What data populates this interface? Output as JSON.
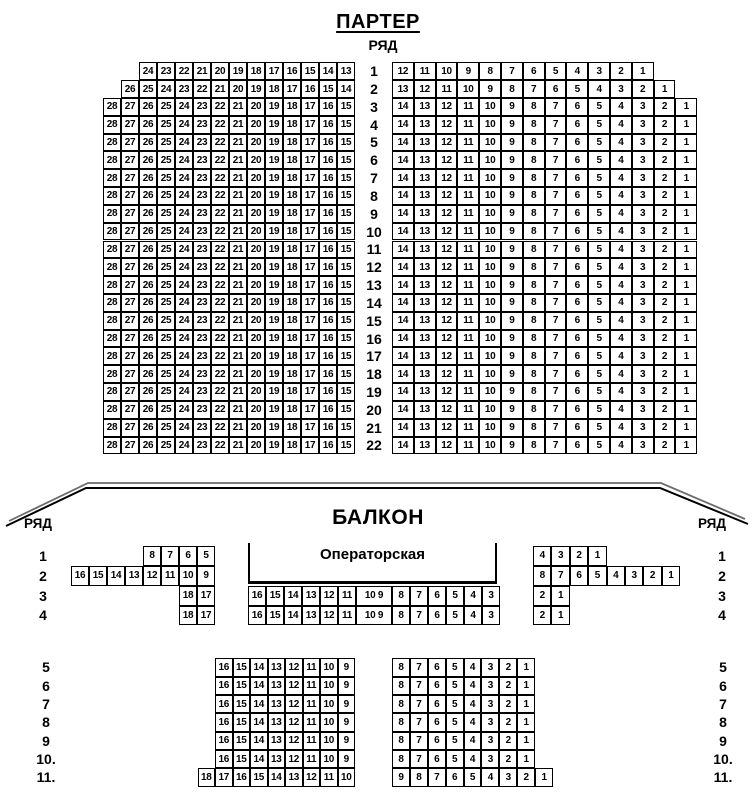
{
  "colors": {
    "ink": "#000000",
    "background": "#ffffff"
  },
  "parterre": {
    "title": "ПАРТЕР",
    "row_header": "РЯД",
    "rows": [
      {
        "row": "1",
        "left": [
          24,
          23,
          22,
          21,
          20,
          19,
          18,
          17,
          16,
          15,
          14,
          13
        ],
        "right": [
          12,
          11,
          10,
          9,
          8,
          7,
          6,
          5,
          4,
          3,
          2,
          1
        ]
      },
      {
        "row": "2",
        "left": [
          26,
          25,
          24,
          23,
          22,
          21,
          20,
          19,
          18,
          17,
          16,
          15,
          14
        ],
        "right": [
          13,
          12,
          11,
          10,
          9,
          8,
          7,
          6,
          5,
          4,
          3,
          2,
          1
        ]
      },
      {
        "row": "3",
        "left": [
          28,
          27,
          26,
          25,
          24,
          23,
          22,
          21,
          20,
          19,
          18,
          17,
          16,
          15
        ],
        "right": [
          14,
          13,
          12,
          11,
          10,
          9,
          8,
          7,
          6,
          5,
          4,
          3,
          2,
          1
        ]
      },
      {
        "row": "4",
        "left": [
          28,
          27,
          26,
          25,
          24,
          23,
          22,
          21,
          20,
          19,
          18,
          17,
          16,
          15
        ],
        "right": [
          14,
          13,
          12,
          11,
          10,
          9,
          8,
          7,
          6,
          5,
          4,
          3,
          2,
          1
        ]
      },
      {
        "row": "5",
        "left": [
          28,
          27,
          26,
          25,
          24,
          23,
          22,
          21,
          20,
          19,
          18,
          17,
          16,
          15
        ],
        "right": [
          14,
          13,
          12,
          11,
          10,
          9,
          8,
          7,
          6,
          5,
          4,
          3,
          2,
          1
        ]
      },
      {
        "row": "6",
        "left": [
          28,
          27,
          26,
          25,
          24,
          23,
          22,
          21,
          20,
          19,
          18,
          17,
          16,
          15
        ],
        "right": [
          14,
          13,
          12,
          11,
          10,
          9,
          8,
          7,
          6,
          5,
          4,
          3,
          2,
          1
        ]
      },
      {
        "row": "7",
        "left": [
          28,
          27,
          26,
          25,
          24,
          23,
          22,
          21,
          20,
          19,
          18,
          17,
          16,
          15
        ],
        "right": [
          14,
          13,
          12,
          11,
          10,
          9,
          8,
          7,
          6,
          5,
          4,
          3,
          2,
          1
        ]
      },
      {
        "row": "8",
        "left": [
          28,
          27,
          26,
          25,
          24,
          23,
          22,
          21,
          20,
          19,
          18,
          17,
          16,
          15
        ],
        "right": [
          14,
          13,
          12,
          11,
          10,
          9,
          8,
          7,
          6,
          5,
          4,
          3,
          2,
          1
        ]
      },
      {
        "row": "9",
        "left": [
          28,
          27,
          26,
          25,
          24,
          23,
          22,
          21,
          20,
          19,
          18,
          17,
          16,
          15
        ],
        "right": [
          14,
          13,
          12,
          11,
          10,
          9,
          8,
          7,
          6,
          5,
          4,
          3,
          2,
          1
        ]
      },
      {
        "row": "10",
        "left": [
          28,
          27,
          26,
          25,
          24,
          23,
          22,
          21,
          20,
          19,
          18,
          17,
          16,
          15
        ],
        "right": [
          14,
          13,
          12,
          11,
          10,
          9,
          8,
          7,
          6,
          5,
          4,
          3,
          2,
          1
        ]
      },
      {
        "row": "11",
        "left": [
          28,
          27,
          26,
          25,
          24,
          23,
          22,
          21,
          20,
          19,
          18,
          17,
          16,
          15
        ],
        "right": [
          14,
          13,
          12,
          11,
          10,
          9,
          8,
          7,
          6,
          5,
          4,
          3,
          2,
          1
        ]
      },
      {
        "row": "12",
        "left": [
          28,
          27,
          26,
          25,
          24,
          23,
          22,
          21,
          20,
          19,
          18,
          17,
          16,
          15
        ],
        "right": [
          14,
          13,
          12,
          11,
          10,
          9,
          8,
          7,
          6,
          5,
          4,
          3,
          2,
          1
        ]
      },
      {
        "row": "13",
        "left": [
          28,
          27,
          26,
          25,
          24,
          23,
          22,
          21,
          20,
          19,
          18,
          17,
          16,
          15
        ],
        "right": [
          14,
          13,
          12,
          11,
          10,
          9,
          8,
          7,
          6,
          5,
          4,
          3,
          2,
          1
        ]
      },
      {
        "row": "14",
        "left": [
          28,
          27,
          26,
          25,
          24,
          23,
          22,
          21,
          20,
          19,
          18,
          17,
          16,
          15
        ],
        "right": [
          14,
          13,
          12,
          11,
          10,
          9,
          8,
          7,
          6,
          5,
          4,
          3,
          2,
          1
        ]
      },
      {
        "row": "15",
        "left": [
          28,
          27,
          26,
          25,
          24,
          23,
          22,
          21,
          20,
          19,
          18,
          17,
          16,
          15
        ],
        "right": [
          14,
          13,
          12,
          11,
          10,
          9,
          8,
          7,
          6,
          5,
          4,
          3,
          2,
          1
        ]
      },
      {
        "row": "16",
        "left": [
          28,
          27,
          26,
          25,
          24,
          23,
          22,
          21,
          20,
          19,
          18,
          17,
          16,
          15
        ],
        "right": [
          14,
          13,
          12,
          11,
          10,
          9,
          8,
          7,
          6,
          5,
          4,
          3,
          2,
          1
        ]
      },
      {
        "row": "17",
        "left": [
          28,
          27,
          26,
          25,
          24,
          23,
          22,
          21,
          20,
          19,
          18,
          17,
          16,
          15
        ],
        "right": [
          14,
          13,
          12,
          11,
          10,
          9,
          8,
          7,
          6,
          5,
          4,
          3,
          2,
          1
        ]
      },
      {
        "row": "18",
        "left": [
          28,
          27,
          26,
          25,
          24,
          23,
          22,
          21,
          20,
          19,
          18,
          17,
          16,
          15
        ],
        "right": [
          14,
          13,
          12,
          11,
          10,
          9,
          8,
          7,
          6,
          5,
          4,
          3,
          2,
          1
        ]
      },
      {
        "row": "19",
        "left": [
          28,
          27,
          26,
          25,
          24,
          23,
          22,
          21,
          20,
          19,
          18,
          17,
          16,
          15
        ],
        "right": [
          14,
          13,
          12,
          11,
          10,
          9,
          8,
          7,
          6,
          5,
          4,
          3,
          2,
          1
        ]
      },
      {
        "row": "20",
        "left": [
          28,
          27,
          26,
          25,
          24,
          23,
          22,
          21,
          20,
          19,
          18,
          17,
          16,
          15
        ],
        "right": [
          14,
          13,
          12,
          11,
          10,
          9,
          8,
          7,
          6,
          5,
          4,
          3,
          2,
          1
        ]
      },
      {
        "row": "21",
        "left": [
          28,
          27,
          26,
          25,
          24,
          23,
          22,
          21,
          20,
          19,
          18,
          17,
          16,
          15
        ],
        "right": [
          14,
          13,
          12,
          11,
          10,
          9,
          8,
          7,
          6,
          5,
          4,
          3,
          2,
          1
        ]
      },
      {
        "row": "22",
        "left": [
          28,
          27,
          26,
          25,
          24,
          23,
          22,
          21,
          20,
          19,
          18,
          17,
          16,
          15
        ],
        "right": [
          14,
          13,
          12,
          11,
          10,
          9,
          8,
          7,
          6,
          5,
          4,
          3,
          2,
          1
        ]
      }
    ]
  },
  "balcony": {
    "title": "БАЛКОН",
    "row_header_left": "РЯД",
    "row_header_right": "РЯД",
    "operator_booth": "Операторская",
    "upper_rows": [
      {
        "row": "1",
        "left": [
          8,
          7,
          6,
          5
        ],
        "center": [],
        "right": [
          4,
          3,
          2,
          1
        ]
      },
      {
        "row": "2",
        "left": [
          16,
          15,
          14,
          13,
          12,
          11,
          10,
          9
        ],
        "center": [],
        "right": [
          8,
          7,
          6,
          5,
          4,
          3,
          2,
          1
        ]
      },
      {
        "row": "3",
        "left": [
          18,
          17
        ],
        "center": [
          "16",
          "15",
          "14",
          "13",
          "12",
          "11",
          "10 9",
          "8",
          "7",
          "6",
          "5",
          "4",
          "3"
        ],
        "right": [
          2,
          1
        ]
      },
      {
        "row": "4",
        "left": [
          18,
          17
        ],
        "center": [
          "16",
          "15",
          "14",
          "13",
          "12",
          "11",
          "10 9",
          "8",
          "7",
          "6",
          "5",
          "4",
          "3"
        ],
        "right": [
          2,
          1
        ]
      }
    ],
    "lower_rows": [
      {
        "row": "5",
        "left": [
          16,
          15,
          14,
          13,
          12,
          11,
          10,
          9
        ],
        "right": [
          8,
          7,
          6,
          5,
          4,
          3,
          2,
          1
        ]
      },
      {
        "row": "6",
        "left": [
          16,
          15,
          14,
          13,
          12,
          11,
          10,
          9
        ],
        "right": [
          8,
          7,
          6,
          5,
          4,
          3,
          2,
          1
        ]
      },
      {
        "row": "7",
        "left": [
          16,
          15,
          14,
          13,
          12,
          11,
          10,
          9
        ],
        "right": [
          8,
          7,
          6,
          5,
          4,
          3,
          2,
          1
        ]
      },
      {
        "row": "8",
        "left": [
          16,
          15,
          14,
          13,
          12,
          11,
          10,
          9
        ],
        "right": [
          8,
          7,
          6,
          5,
          4,
          3,
          2,
          1
        ]
      },
      {
        "row": "9",
        "left": [
          16,
          15,
          14,
          13,
          12,
          11,
          10,
          9
        ],
        "right": [
          8,
          7,
          6,
          5,
          4,
          3,
          2,
          1
        ]
      },
      {
        "row": "10.",
        "left": [
          16,
          15,
          14,
          13,
          12,
          11,
          10,
          9
        ],
        "right": [
          8,
          7,
          6,
          5,
          4,
          3,
          2,
          1
        ]
      },
      {
        "row": "11.",
        "left": [
          18,
          17,
          16,
          15,
          14,
          13,
          12,
          11,
          10
        ],
        "right": [
          9,
          8,
          7,
          6,
          5,
          4,
          3,
          2,
          1
        ]
      }
    ]
  }
}
